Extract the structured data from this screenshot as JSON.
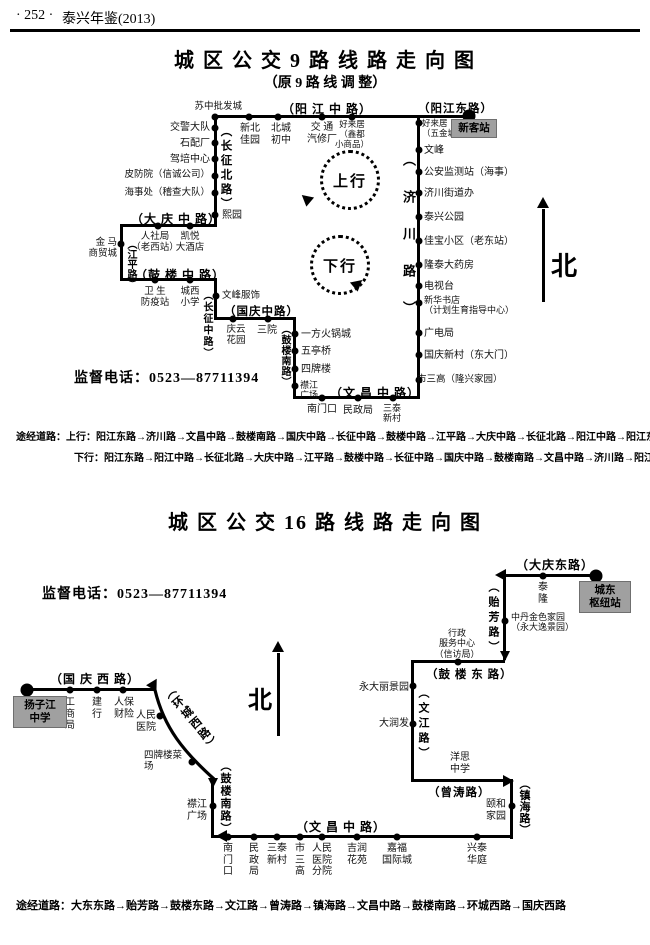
{
  "colors": {
    "ink": "#000000",
    "terminal_bg": "#a0a0a0"
  },
  "header": {
    "page_marker": "· 252 ·",
    "book_title": "泰兴年鉴(2013)"
  },
  "map9": {
    "title": "城 区 公 交 9 路 线 路 走 向 图",
    "subtitle": "（原 9 路 线 调 整）",
    "phone": "监督电话：0523—87711394",
    "north": "北",
    "loop_up": "上行",
    "loop_down": "下行",
    "terminal": "新客站",
    "roads": {
      "yjzl": "（阳 江 中 路）",
      "yjdl": "（阳江东路）",
      "czbl": "（长征北路）",
      "dqzl": "（大 庆 中 路）",
      "jpl": "（江平路）",
      "glzl": "（鼓 楼 中 路）",
      "czzl": "（长征中路）",
      "gqzl": "（国庆中路）",
      "glnl": "（鼓楼南路）",
      "wczl": "（文 昌 中 路）",
      "jcl": "（济川路）"
    },
    "stops": {
      "szpfc": "苏中批发城",
      "xbjy": "新北\n佳园",
      "bccz": "北城\n初中",
      "jtqxc": "交 通\n汽修厂",
      "hlj_top": "好来居\n（鑫都\n小商品）",
      "jjdd": "交警大队",
      "spc": "石配厂",
      "jpzx": "驾培中心",
      "pfy": "皮防院（信诚公司）",
      "hsc": "海事处（稽查大队）",
      "xy": "熙园",
      "rsj": "人社局\n（老西站）",
      "kydjd": "凯悦\n大酒店",
      "jmsmc": "金 马\n商贸城",
      "wsfyz": "卫 生\n防疫站",
      "cxxx": "城西\n小学",
      "wffs": "文峰服饰",
      "qyhy": "庆云\n花园",
      "sy": "三院",
      "yfhgc": "一方火锅城",
      "wtq": "五亭桥",
      "spl": "四牌楼",
      "jjgc": "襟江\n广场",
      "nmk": "南门口",
      "mzj": "民政局",
      "stxc": "三泰\n新村",
      "hlj_right": "好来居\n（五金城）",
      "wf": "文峰",
      "gajcz": "公安监测站（海事）",
      "jcjdb": "济川街道办",
      "txgy": "泰兴公园",
      "jbxq": "佳宝小区（老东站）",
      "ltdyf": "隆泰大药房",
      "dst": "电视台",
      "xhsd": "新华书店\n（计划生育指导中心）",
      "gdj": "广电局",
      "gqxc": "国庆新村（东大门）",
      "ssg": "市三高（隆兴家园）"
    },
    "notes": {
      "up": "途经道路：上行：阳江东路→济川路→文昌中路→鼓楼南路→国庆中路→长征中路→鼓楼中路→江平路→大庆中路→长征北路→阳江中路→阳江东路",
      "down": "下行：阳江东路→阳江中路→长征北路→大庆中路→江平路→鼓楼中路→长征中路→国庆中路→鼓楼南路→文昌中路→济川路→阳江东路"
    }
  },
  "map16": {
    "title": "城 区 公 交 16 路 线 路 走 向 图",
    "phone": "监督电话：0523—87711394",
    "north": "北",
    "terminal_east": "城东\n枢纽站",
    "terminal_west": "扬子江\n中学",
    "roads": {
      "dqdl": "（大庆东路）",
      "yfl": "（贻芳路）",
      "gldl": "（鼓 楼 东 路）",
      "wjl": "（文江路）",
      "ztl": "（曾涛路）",
      "zhl": "（镇海路）",
      "wczl": "（文 昌 中 路）",
      "glnl": "（鼓楼南路）",
      "hcxl": "（环城西路）",
      "gqxl": "（国 庆 西 路）"
    },
    "stops": {
      "tl": "泰\n隆",
      "zdjsjy": "中丹金色家园\n（永大逸景园）",
      "xzfwzx": "行政\n服务中心\n（信访局）",
      "ydljy": "永大丽景园",
      "drf": "大润发",
      "yszx": "洋思\n中学",
      "yhjy": "颐和\n家园",
      "nmk": "南\n门\n口",
      "mzj": "民\n政\n局",
      "stxc": "三泰\n新村",
      "ssg": "市\n三\n高",
      "rmyyfy": "人民\n医院\n分院",
      "jrhy": "吉润\n花苑",
      "jfgjc": "嘉福\n国际城",
      "xtht": "兴泰\n华庭",
      "jjgc": "襟江\n广场",
      "gsj": "工\n商\n局",
      "jh": "建\n行",
      "rbcx": "人保\n财险",
      "rmyy": "人民\n医院",
      "splcc": "四牌楼菜\n场"
    },
    "note": "途经道路：大东东路→贻芳路→鼓楼东路→文江路→曾涛路→镇海路→文昌中路→鼓楼南路→环城西路→国庆西路"
  }
}
